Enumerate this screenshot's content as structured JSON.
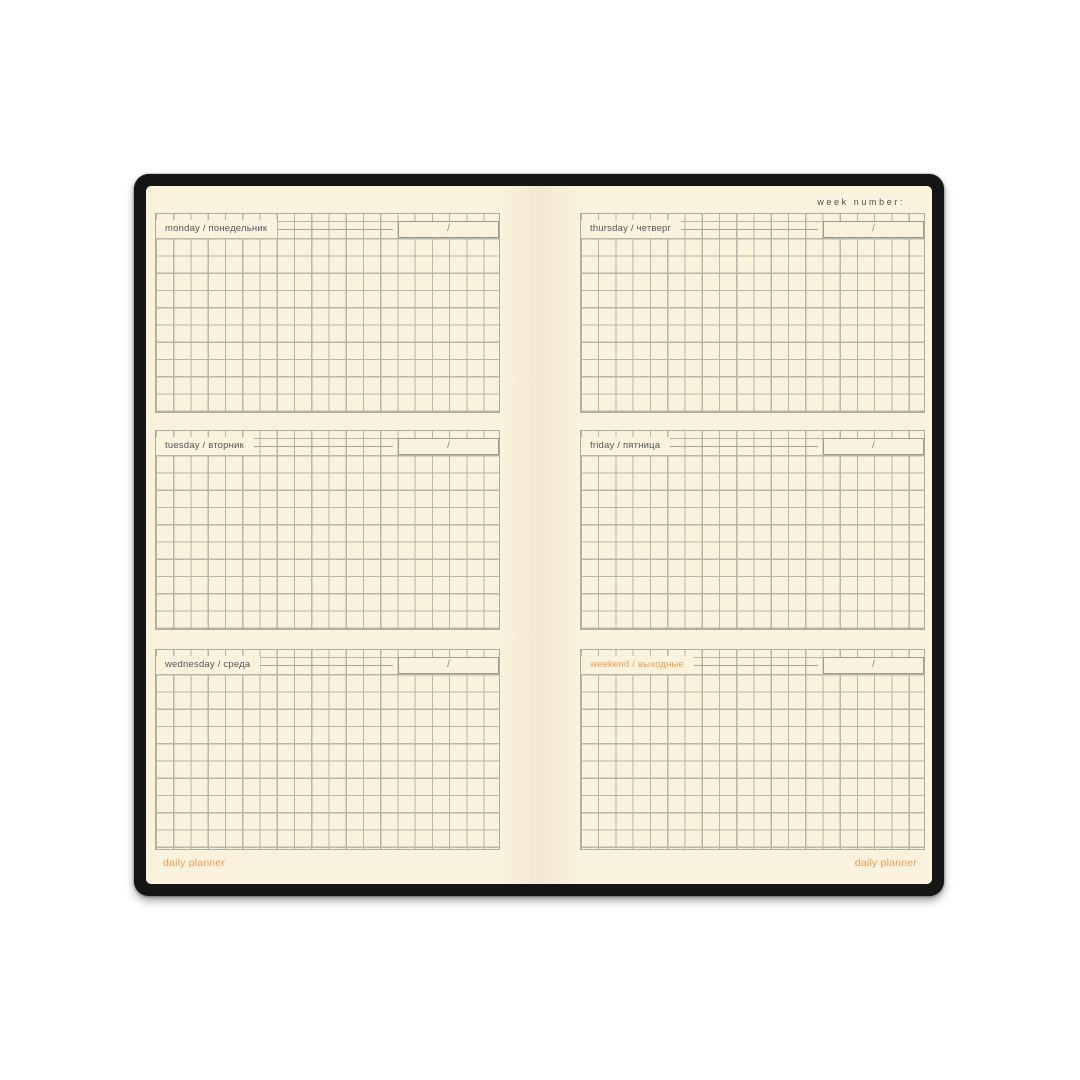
{
  "planner": {
    "week_number_label": "week number:",
    "date_placeholder": "/",
    "footer": {
      "left": "daily planner",
      "right": "daily planner"
    },
    "colors": {
      "cover_black": "#151515",
      "page_cream": "#fbf2de",
      "grid_line": "#adab9c",
      "label_text": "#54565a",
      "accent_orange": "#ef9d4c"
    },
    "left_page": {
      "sections": [
        {
          "label": "monday / понедельник"
        },
        {
          "label": "tuesday / вторник"
        },
        {
          "label": "wednesday / среда"
        }
      ]
    },
    "right_page": {
      "sections": [
        {
          "label": "thursday / четверг"
        },
        {
          "label": "friday / пятница"
        },
        {
          "label": "weekend / выходные"
        }
      ]
    }
  }
}
